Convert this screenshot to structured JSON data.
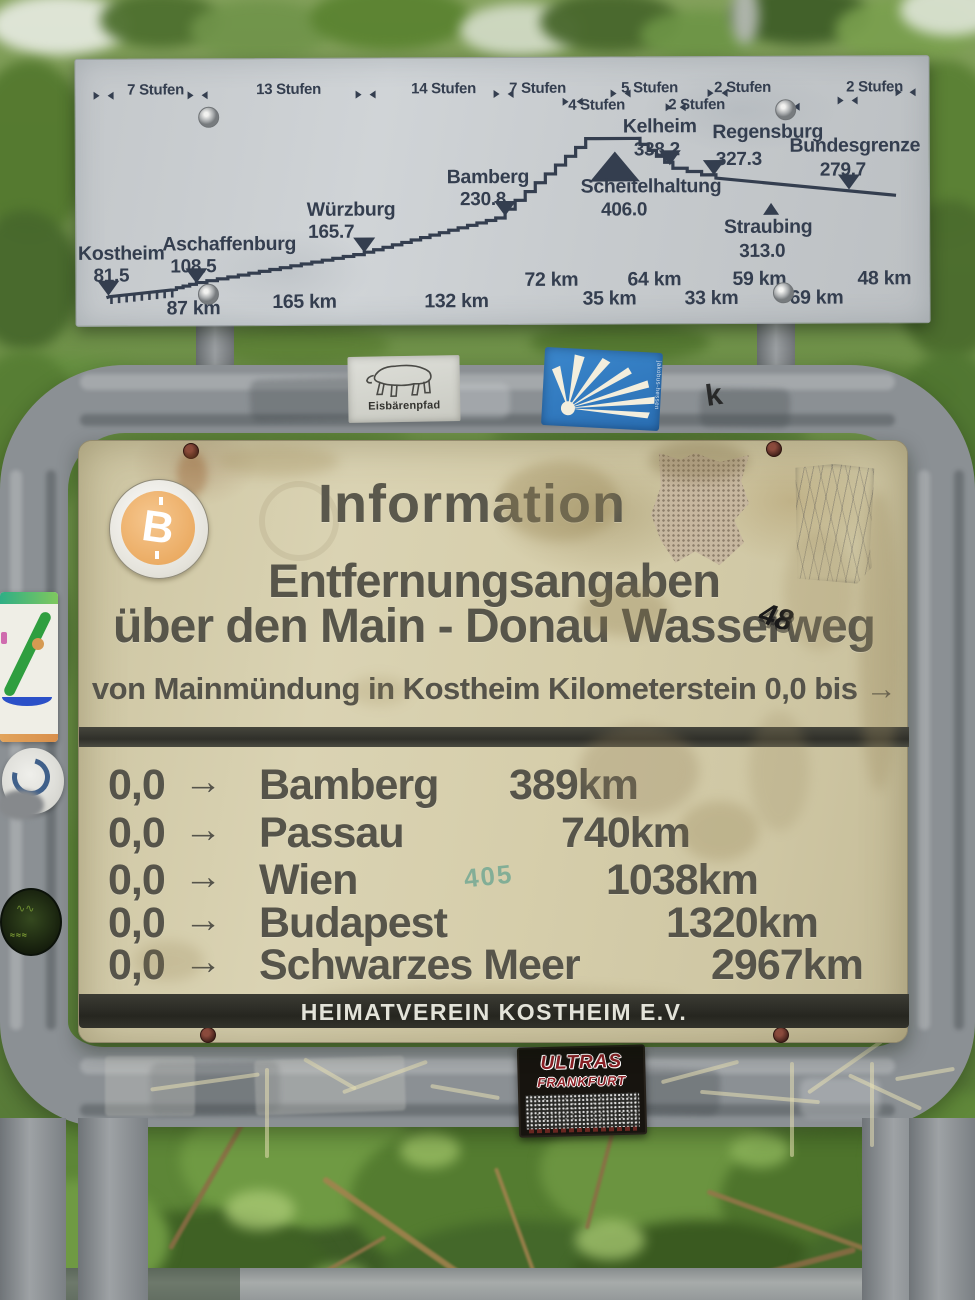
{
  "colors": {
    "profile_ink": "#343e4f",
    "sign_cream": "#d7d0ae",
    "sign_text": "#56544a",
    "band_bg": "#30302a",
    "frame_gray": "#8b9094",
    "btc_orange": "#eaa95f",
    "jakobsweg_blue": "#2e79c0"
  },
  "profile_sign": {
    "stufen_labels": [
      {
        "label": "7 Stufen",
        "x": 80,
        "y": 30
      },
      {
        "label": "13 Stufen",
        "x": 213,
        "y": 30
      },
      {
        "label": "14 Stufen",
        "x": 368,
        "y": 30
      },
      {
        "label": "7 Stufen",
        "x": 462,
        "y": 30
      },
      {
        "label": "4 Stufen",
        "x": 521,
        "y": 47
      },
      {
        "label": "5 Stufen",
        "x": 574,
        "y": 30
      },
      {
        "label": "2 Stufen",
        "x": 621,
        "y": 47
      },
      {
        "label": "2 Stufen",
        "x": 667,
        "y": 30
      },
      {
        "label": "2 Stufen",
        "x": 799,
        "y": 30
      }
    ],
    "cities": [
      {
        "name": "Kostheim",
        "elev": "81.5",
        "marker": "down",
        "mx": 32,
        "my": 236,
        "nx": 45,
        "ny": 193,
        "ex": 35,
        "ey": 215
      },
      {
        "name": "Aschaffenburg",
        "elev": "108.5",
        "marker": "down",
        "mx": 120,
        "my": 224,
        "nx": 153,
        "ny": 184,
        "ex": 117,
        "ey": 206
      },
      {
        "name": "Würzburg",
        "elev": "165.7",
        "marker": "down",
        "mx": 288,
        "my": 194,
        "nx": 275,
        "ny": 150,
        "ex": 255,
        "ey": 172
      },
      {
        "name": "Bamberg",
        "elev": "230.8",
        "marker": "down",
        "mx": 429,
        "my": 158,
        "nx": 412,
        "ny": 118,
        "ex": 407,
        "ey": 140
      },
      {
        "name": "Scheitelhaltung",
        "elev": "406.0",
        "marker": "up-large",
        "mx": 539,
        "my": 94,
        "nx": 575,
        "ny": 128,
        "ex": 548,
        "ey": 151
      },
      {
        "name": "Kelheim",
        "elev": "338.2",
        "marker": "down",
        "mx": 594,
        "my": 108,
        "nx": 584,
        "ny": 68,
        "ex": 581,
        "ey": 91
      },
      {
        "name": "Regensburg",
        "elev": "327.3",
        "marker": "down",
        "mx": 638,
        "my": 118,
        "nx": 692,
        "ny": 74,
        "ex": 663,
        "ey": 101
      },
      {
        "name": "Straubing",
        "elev": "313.0",
        "marker": "up-small",
        "mx": 695,
        "my": 146,
        "nx": 692,
        "ny": 169,
        "ex": 686,
        "ey": 193
      },
      {
        "name": "Bundesgrenze",
        "elev": "279.7",
        "marker": "down",
        "mx": 773,
        "my": 133,
        "nx": 779,
        "ny": 88,
        "ex": 767,
        "ey": 112
      }
    ],
    "km_labels": [
      {
        "t": "87 km",
        "x": 117,
        "y": 248
      },
      {
        "t": "165 km",
        "x": 228,
        "y": 242
      },
      {
        "t": "132 km",
        "x": 380,
        "y": 242
      },
      {
        "t": "72 km",
        "x": 475,
        "y": 221
      },
      {
        "t": "35 km",
        "x": 533,
        "y": 240
      },
      {
        "t": "64 km",
        "x": 578,
        "y": 221
      },
      {
        "t": "33 km",
        "x": 635,
        "y": 240
      },
      {
        "t": "59 km",
        "x": 683,
        "y": 221
      },
      {
        "t": "69 km",
        "x": 740,
        "y": 240
      },
      {
        "t": "48 km",
        "x": 808,
        "y": 221
      }
    ]
  },
  "info_sign": {
    "title": "Information",
    "subtitle1": "Entfernungsangaben",
    "subtitle2": "über den Main - Donau Wasserweg",
    "note": "von Mainmündung in Kostheim Kilometerstein 0,0 bis →",
    "rows": [
      {
        "from": "0,0",
        "arrow": "→",
        "city": "Bamberg",
        "dist": "389km",
        "indent": 430
      },
      {
        "from": "0,0",
        "arrow": "→",
        "city": "Passau",
        "dist": "740km",
        "indent": 482
      },
      {
        "from": "0,0",
        "arrow": "→",
        "city": "Wien",
        "dist": "1038km",
        "indent": 527
      },
      {
        "from": "0,0",
        "arrow": "→",
        "city": "Budapest",
        "dist": "1320km",
        "indent": 587
      },
      {
        "from": "0,0",
        "arrow": "→",
        "city": "Schwarzes Meer",
        "dist": "2967km",
        "indent": 632
      }
    ],
    "footer": "HEIMATVEREIN KOSTHEIM E.V.",
    "graffiti": "48",
    "stamp": "405"
  },
  "stickers": {
    "bitcoin": {
      "symbol": "B"
    },
    "eisbaerenpfad": {
      "label": "Eisbärenpfad"
    },
    "jakobsweg": {
      "side_text": "jakobus-hessen"
    },
    "ultras": {
      "line1": "ULTRAS",
      "line2": "FRANKFURT"
    }
  },
  "chart_data": {
    "type": "line",
    "title": "Main-Donau Wasserweg elevation profile",
    "stations": [
      {
        "name": "Kostheim",
        "elevation_m": 81.5
      },
      {
        "name": "Aschaffenburg",
        "elevation_m": 108.5
      },
      {
        "name": "Würzburg",
        "elevation_m": 165.7
      },
      {
        "name": "Bamberg",
        "elevation_m": 230.8
      },
      {
        "name": "Scheitelhaltung",
        "elevation_m": 406.0
      },
      {
        "name": "Kelheim",
        "elevation_m": 338.2
      },
      {
        "name": "Regensburg",
        "elevation_m": 327.3
      },
      {
        "name": "Straubing",
        "elevation_m": 313.0
      },
      {
        "name": "Bundesgrenze",
        "elevation_m": 279.7
      }
    ],
    "segment_distances_km": [
      87,
      165,
      132,
      72,
      35,
      64,
      33,
      59,
      69,
      48
    ],
    "locks_per_segment": [
      "7 Stufen",
      "13 Stufen",
      "14 Stufen",
      "7 Stufen",
      "4 Stufen",
      "5 Stufen",
      "2 Stufen",
      "2 Stufen",
      "2 Stufen"
    ]
  }
}
